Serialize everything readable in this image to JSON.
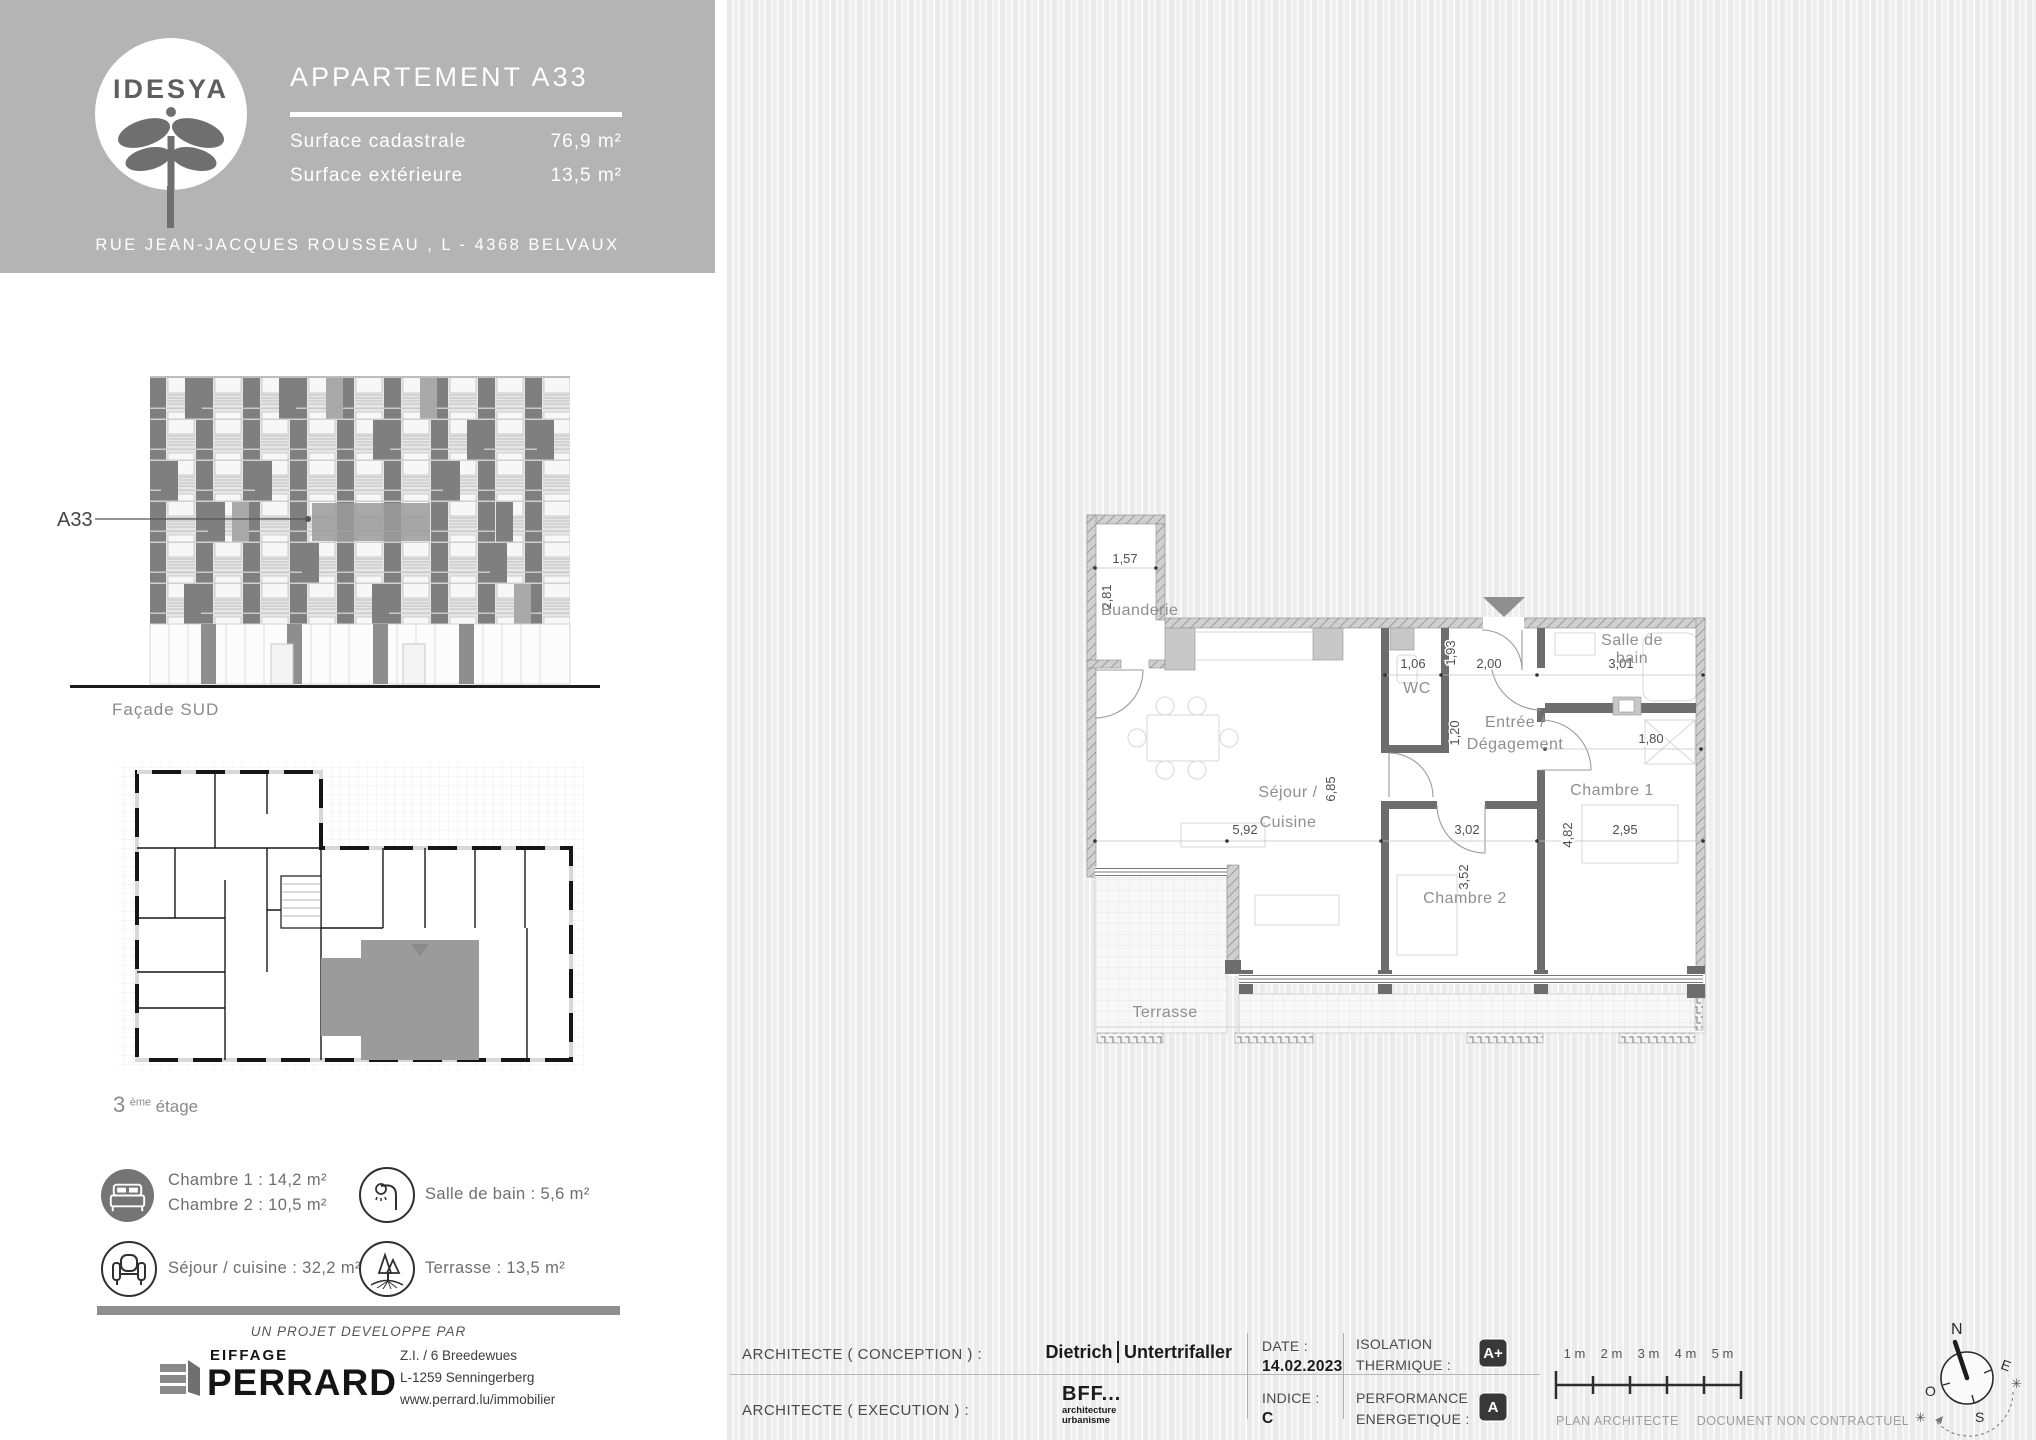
{
  "header": {
    "logo_text": "IDESYA",
    "title": "APPARTEMENT A33",
    "surface_rows": [
      {
        "label": "Surface cadastrale",
        "value": "76,9 m²"
      },
      {
        "label": "Surface extérieure",
        "value": "13,5 m²"
      }
    ],
    "address": "RUE JEAN-JACQUES ROUSSEAU , L - 4368 BELVAUX"
  },
  "facade": {
    "apartment_label": "A33",
    "caption": "Façade SUD"
  },
  "keyplan": {
    "caption_number": "3",
    "caption_sup": "ème",
    "caption_word": "étage"
  },
  "legend": {
    "bedrooms_line1": "Chambre 1 : 14,2 m²",
    "bedrooms_line2": "Chambre 2 : 10,5 m²",
    "bathroom": "Salle de bain : 5,6 m²",
    "living": "Séjour / cuisine : 32,2 m²",
    "terrace": "Terrasse : 13,5 m²"
  },
  "developer": {
    "tagline": "UN PROJET DEVELOPPE PAR",
    "brand_top": "EIFFAGE",
    "brand_main": "PERRARD",
    "address_line1": "Z.I. / 6 Breedewues",
    "address_line2": "L-1259 Senningerberg",
    "address_line3": "www.perrard.lu/immobilier"
  },
  "plan": {
    "rooms": {
      "buanderie": "Buanderie",
      "sejour_line1": "Séjour /",
      "sejour_line2": "Cuisine",
      "wc": "WC",
      "entree_line1": "Entrée /",
      "entree_line2": "Dégagement",
      "sdb_line1": "Salle de",
      "sdb_line2": "bain",
      "chambre1": "Chambre 1",
      "chambre2": "Chambre 2",
      "terrasse": "Terrasse"
    },
    "dims": {
      "buanderie_w": "1,57",
      "buanderie_h": "2,81",
      "wc_w": "1,06",
      "entree_h1": "1,93",
      "entree_w": "2,00",
      "sdb_w": "3,01",
      "entree_h2": "1,20",
      "ch1_top": "1,80",
      "sejour_h": "6,85",
      "sejour_w": "5,92",
      "ch2_w": "3,02",
      "ch2_h": "3,52",
      "ch1_h": "4,82",
      "ch1_w": "2,95"
    }
  },
  "footer": {
    "conception_label": "ARCHITECTE ( CONCEPTION ) :",
    "conception_name1": "Dietrich",
    "conception_name2": "Untertrifaller",
    "execution_label": "ARCHITECTE ( EXECUTION ) :",
    "execution_name": "BFF...",
    "execution_sub1": "architecture",
    "execution_sub2": "urbanisme",
    "date_label": "DATE :",
    "date_value": "14.02.2023",
    "indice_label": "INDICE :",
    "indice_value": "C",
    "isolation_label1": "ISOLATION",
    "isolation_label2": "THERMIQUE :",
    "isolation_value": "A+",
    "performance_label1": "PERFORMANCE",
    "performance_label2": "ENERGETIQUE :",
    "performance_value": "A",
    "note1": "PLAN ARCHITECTE",
    "note2": "DOCUMENT NON CONTRACTUEL"
  },
  "scalebar": {
    "labels": [
      "1 m",
      "2 m",
      "3 m",
      "4 m",
      "5 m"
    ]
  },
  "compass": {
    "n": "N",
    "e": "E",
    "o": "O",
    "s": "S"
  },
  "colors": {
    "header_bg": "#b4b4b4",
    "stripe_dark": "#eaeaea",
    "badge_bg": "#383838",
    "plan_highlight": "#9b9b9b"
  }
}
